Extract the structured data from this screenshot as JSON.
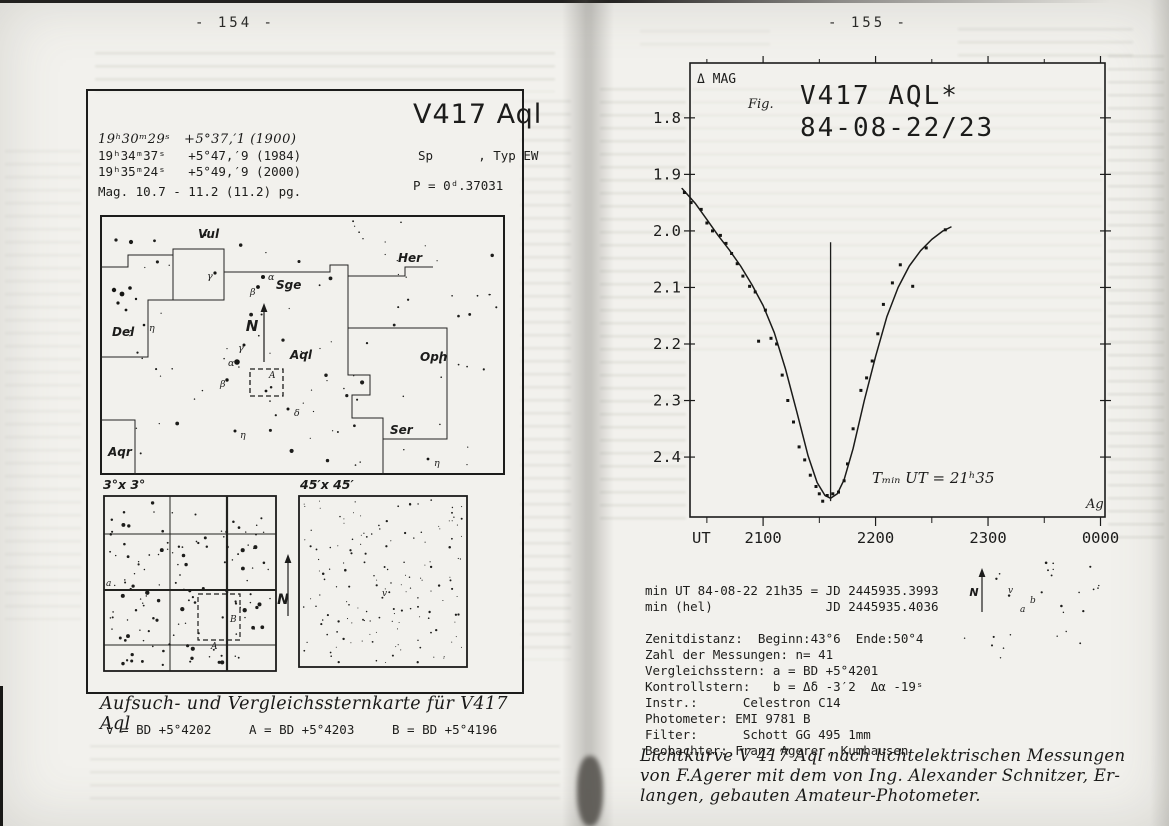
{
  "colors": {
    "ink": "#1c1c1b",
    "paper": "#f2f1ed",
    "ghost_bleed": "#6e7260"
  },
  "page_left": {
    "page_number": "- 154 -",
    "header": {
      "title": "V417 Aql",
      "sp_line": "Sp      , Typ EW",
      "period": "P = 0ᵈ.37031",
      "magnitude": "Mag. 10.7 - 11.2 (11.2) pg.",
      "coords": [
        "19ʰ30ᵐ29ˢ   +5°37,′1 (1900)",
        "19ʰ34ᵐ37ˢ   +5°47,′9 (1984)",
        "19ʰ35ᵐ24ˢ   +5°49,′9 (2000)"
      ]
    },
    "main_map": {
      "north_label": "N",
      "var_field_label": "A",
      "constellations": [
        {
          "t": "Vul",
          "x": 98,
          "y": 23
        },
        {
          "t": "Sge",
          "x": 176,
          "y": 74
        },
        {
          "t": "Her",
          "x": 298,
          "y": 47
        },
        {
          "t": "Del",
          "x": 12,
          "y": 121
        },
        {
          "t": "Aql",
          "x": 190,
          "y": 144
        },
        {
          "t": "Oph",
          "x": 320,
          "y": 146
        },
        {
          "t": "Ser",
          "x": 290,
          "y": 219
        },
        {
          "t": "Aqr",
          "x": 8,
          "y": 241
        }
      ],
      "star_labels": [
        {
          "t": "γ",
          "x": 107,
          "y": 64
        },
        {
          "t": "α",
          "x": 168,
          "y": 65
        },
        {
          "t": "β",
          "x": 150,
          "y": 80
        },
        {
          "t": "γ",
          "x": 138,
          "y": 136
        },
        {
          "t": "α",
          "x": 128,
          "y": 151
        },
        {
          "t": "β",
          "x": 120,
          "y": 172
        },
        {
          "t": "δ",
          "x": 194,
          "y": 201
        },
        {
          "t": "η",
          "x": 140,
          "y": 223
        },
        {
          "t": "η",
          "x": 334,
          "y": 251
        },
        {
          "t": "η",
          "x": 49,
          "y": 116
        }
      ],
      "labeled_stars": [
        [
          115,
          58,
          1.6
        ],
        [
          163,
          62,
          2.0
        ],
        [
          158,
          72,
          1.9
        ],
        [
          144,
          130,
          1.5
        ],
        [
          137,
          147,
          2.8
        ],
        [
          127,
          165,
          1.7
        ],
        [
          188,
          194,
          1.5
        ],
        [
          135,
          216,
          1.5
        ],
        [
          328,
          244,
          1.4
        ],
        [
          44,
          110,
          1.3
        ],
        [
          14,
          75,
          2.2
        ],
        [
          22,
          79,
          2.4
        ],
        [
          30,
          73,
          1.8
        ],
        [
          18,
          88,
          1.6
        ],
        [
          36,
          84,
          1.2
        ],
        [
          26,
          95,
          1.4
        ],
        [
          166,
          176,
          1.4
        ]
      ],
      "boundaries": [
        [
          [
            0,
            52
          ],
          [
            28,
            52
          ],
          [
            28,
            40
          ],
          [
            73,
            40
          ],
          [
            73,
            34
          ],
          [
            124,
            34
          ],
          [
            124,
            57
          ],
          [
            230,
            57
          ],
          [
            230,
            50
          ],
          [
            248,
            50
          ],
          [
            248,
            61
          ],
          [
            305,
            61
          ],
          [
            305,
            52
          ],
          [
            333,
            52
          ]
        ],
        [
          [
            73,
            40
          ],
          [
            73,
            85
          ],
          [
            124,
            85
          ],
          [
            124,
            57
          ]
        ],
        [
          [
            73,
            85
          ],
          [
            48,
            85
          ],
          [
            48,
            142
          ],
          [
            0,
            142
          ]
        ],
        [
          [
            0,
            205
          ],
          [
            35,
            205
          ],
          [
            35,
            260
          ]
        ],
        [
          [
            248,
            61
          ],
          [
            248,
            113
          ],
          [
            347,
            113
          ],
          [
            347,
            224
          ],
          [
            283,
            224
          ],
          [
            283,
            203
          ],
          [
            252,
            203
          ],
          [
            252,
            180
          ],
          [
            270,
            180
          ],
          [
            270,
            160
          ],
          [
            248,
            160
          ],
          [
            248,
            113
          ]
        ],
        [
          [
            283,
            224
          ],
          [
            283,
            260
          ]
        ]
      ],
      "scatter": {
        "seed": 11,
        "count": 95,
        "rmin": 0.6,
        "rmax": 2.1
      }
    },
    "panel_3x3": {
      "label": "3°x 3°",
      "label_b": "B",
      "label_a": "A",
      "edge_label": "a",
      "grid_v": [
        67,
        124
      ],
      "grid_h": [
        39,
        95,
        150
      ],
      "thick_v": 124,
      "thick_h": 95,
      "dash_rect": [
        95,
        99,
        42,
        46
      ],
      "scatter": {
        "seed": 23,
        "count": 135,
        "rmin": 0.7,
        "rmax": 2.2
      }
    },
    "panel_45": {
      "label": "45′x 45′",
      "var_label": "v",
      "scatter": {
        "seed": 37,
        "count": 155,
        "rmin": 0.5,
        "rmax": 1.3
      }
    },
    "north_between_label": "N",
    "caption": "Aufsuch- und Vergleichssternkarte für V417 Aql",
    "comparison_line": "v = BD +5°4202     A = BD +5°4203     B = BD +5°4196"
  },
  "page_right": {
    "page_number": "- 155 -",
    "observation_lines": [
      "min UT 84-08-22 21h35 = JD 2445935.3993",
      "min (hel)               JD 2445935.4036",
      "",
      "Zenitdistanz:  Beginn:43°6  Ende:50°4",
      "Zahl der Messungen: n= 41",
      "Vergleichsstern: a = BD +5°4201",
      "Kontrollstern:   b = Δδ -3′2  Δα -19ˢ",
      "Instr.:      Celestron C14",
      "Photometer: EMI 9781 B",
      "Filter:      Schott GG 495 1mm",
      "Beobachter: Franz Agerer, Kumhausen"
    ],
    "caption_lines": [
      "Lichtkurve V 417 Aql nach lichtelektrischen Messungen",
      "von F.Agerer mit dem von Ing. Alexander Schnitzer, Er-",
      "langen, gebauten Amateur-Photometer."
    ],
    "mini_field": {
      "north_label": "N",
      "labels": [
        {
          "t": "v",
          "x": 58,
          "y": 37
        },
        {
          "t": "a",
          "x": 70,
          "y": 56
        },
        {
          "t": "b",
          "x": 80,
          "y": 47
        }
      ],
      "scatter": {
        "seed": 5,
        "count": 26,
        "rmin": 0.7,
        "rmax": 1.4
      }
    }
  },
  "chart_data": {
    "type": "scatter+line",
    "title_line1": "V417 AQL*",
    "title_line2": "84-08-22/23",
    "fig_label": "Fig.",
    "ylabel": "Δ MAG",
    "xlabel": "UT",
    "annotation": "Tₘᵢₙ UT = 21ʰ35",
    "signature": "Ag",
    "ylim": [
      1.703,
      2.506
    ],
    "xlim": [
      20.35,
      24.04
    ],
    "yticks": [
      "1.8",
      "1.9",
      "2.0",
      "2.1",
      "2.2",
      "2.3",
      "2.4"
    ],
    "xticks": [
      {
        "v": 21,
        "label": "2100"
      },
      {
        "v": 22,
        "label": "2200"
      },
      {
        "v": 23,
        "label": "2300"
      },
      {
        "v": 24,
        "label": "0000"
      }
    ],
    "xticks_minor": [
      20.5,
      21.5,
      22.5,
      23.5
    ],
    "grid": false,
    "min_marker": {
      "t": 21.6,
      "mag_top": 2.02,
      "mag_bottom": 2.478
    },
    "points": [
      [
        20.3,
        1.932
      ],
      [
        20.36,
        1.95
      ],
      [
        20.45,
        1.962
      ],
      [
        20.5,
        1.986
      ],
      [
        20.55,
        2.0
      ],
      [
        20.62,
        2.008
      ],
      [
        20.67,
        2.022
      ],
      [
        20.72,
        2.04
      ],
      [
        20.77,
        2.058
      ],
      [
        20.82,
        2.08
      ],
      [
        20.88,
        2.098
      ],
      [
        20.93,
        2.108
      ],
      [
        20.96,
        2.195
      ],
      [
        21.02,
        2.14
      ],
      [
        21.07,
        2.19
      ],
      [
        21.12,
        2.2
      ],
      [
        21.17,
        2.255
      ],
      [
        21.22,
        2.3
      ],
      [
        21.27,
        2.338
      ],
      [
        21.32,
        2.382
      ],
      [
        21.37,
        2.405
      ],
      [
        21.42,
        2.432
      ],
      [
        21.47,
        2.452
      ],
      [
        21.5,
        2.465
      ],
      [
        21.53,
        2.478
      ],
      [
        21.57,
        2.468
      ],
      [
        21.62,
        2.465
      ],
      [
        21.67,
        2.462
      ],
      [
        21.72,
        2.442
      ],
      [
        21.75,
        2.412
      ],
      [
        21.8,
        2.35
      ],
      [
        21.87,
        2.282
      ],
      [
        21.92,
        2.26
      ],
      [
        21.97,
        2.23
      ],
      [
        22.02,
        2.182
      ],
      [
        22.07,
        2.13
      ],
      [
        22.15,
        2.092
      ],
      [
        22.22,
        2.06
      ],
      [
        22.33,
        2.098
      ],
      [
        22.45,
        2.03
      ],
      [
        22.62,
        1.998
      ]
    ],
    "curve": [
      [
        20.28,
        1.925
      ],
      [
        20.4,
        1.952
      ],
      [
        20.5,
        1.98
      ],
      [
        20.6,
        2.008
      ],
      [
        20.7,
        2.034
      ],
      [
        20.8,
        2.062
      ],
      [
        20.9,
        2.095
      ],
      [
        21.0,
        2.132
      ],
      [
        21.1,
        2.18
      ],
      [
        21.2,
        2.245
      ],
      [
        21.3,
        2.32
      ],
      [
        21.4,
        2.398
      ],
      [
        21.48,
        2.445
      ],
      [
        21.55,
        2.468
      ],
      [
        21.6,
        2.473
      ],
      [
        21.66,
        2.465
      ],
      [
        21.72,
        2.44
      ],
      [
        21.8,
        2.385
      ],
      [
        21.9,
        2.3
      ],
      [
        22.0,
        2.222
      ],
      [
        22.1,
        2.152
      ],
      [
        22.2,
        2.1
      ],
      [
        22.3,
        2.062
      ],
      [
        22.4,
        2.035
      ],
      [
        22.5,
        2.015
      ],
      [
        22.6,
        2.0
      ],
      [
        22.67,
        1.993
      ]
    ]
  }
}
